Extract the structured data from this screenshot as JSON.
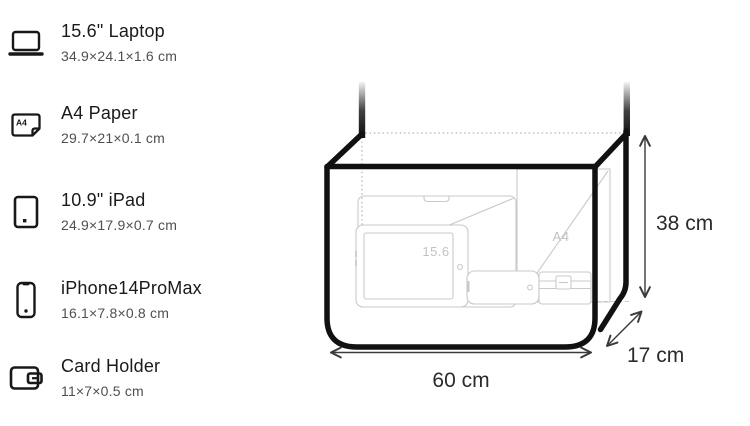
{
  "legend": {
    "items": [
      {
        "icon": "laptop-icon",
        "name": "15.6\" Laptop",
        "dimensions": "34.9×24.1×1.6 cm"
      },
      {
        "icon": "a4-paper-icon",
        "name": "A4 Paper",
        "dimensions": "29.7×21×0.1 cm"
      },
      {
        "icon": "ipad-icon",
        "name": "10.9\" iPad",
        "dimensions": "24.9×17.9×0.7 cm"
      },
      {
        "icon": "iphone-icon",
        "name": "iPhone14ProMax",
        "dimensions": "16.1×7.8×0.8 cm"
      },
      {
        "icon": "card-holder-icon",
        "name": "Card Holder",
        "dimensions": "11×7×0.5 cm"
      }
    ],
    "a4_icon_label": "A4"
  },
  "diagram": {
    "type": "bag-capacity-illustration",
    "bag_dimensions": {
      "width_label": "60 cm",
      "height_label": "38 cm",
      "depth_label": "17 cm"
    },
    "content_labels": {
      "laptop": "15.6",
      "a4_paper": "A4"
    },
    "colors": {
      "bag_outline": "#111111",
      "item_outline": "#c7cacd",
      "item_label": "#c0c3c6",
      "dotted_guide": "#c4c4c4",
      "dimension_line": "#3a3a3a",
      "dimension_text": "#2b2b2b"
    }
  }
}
